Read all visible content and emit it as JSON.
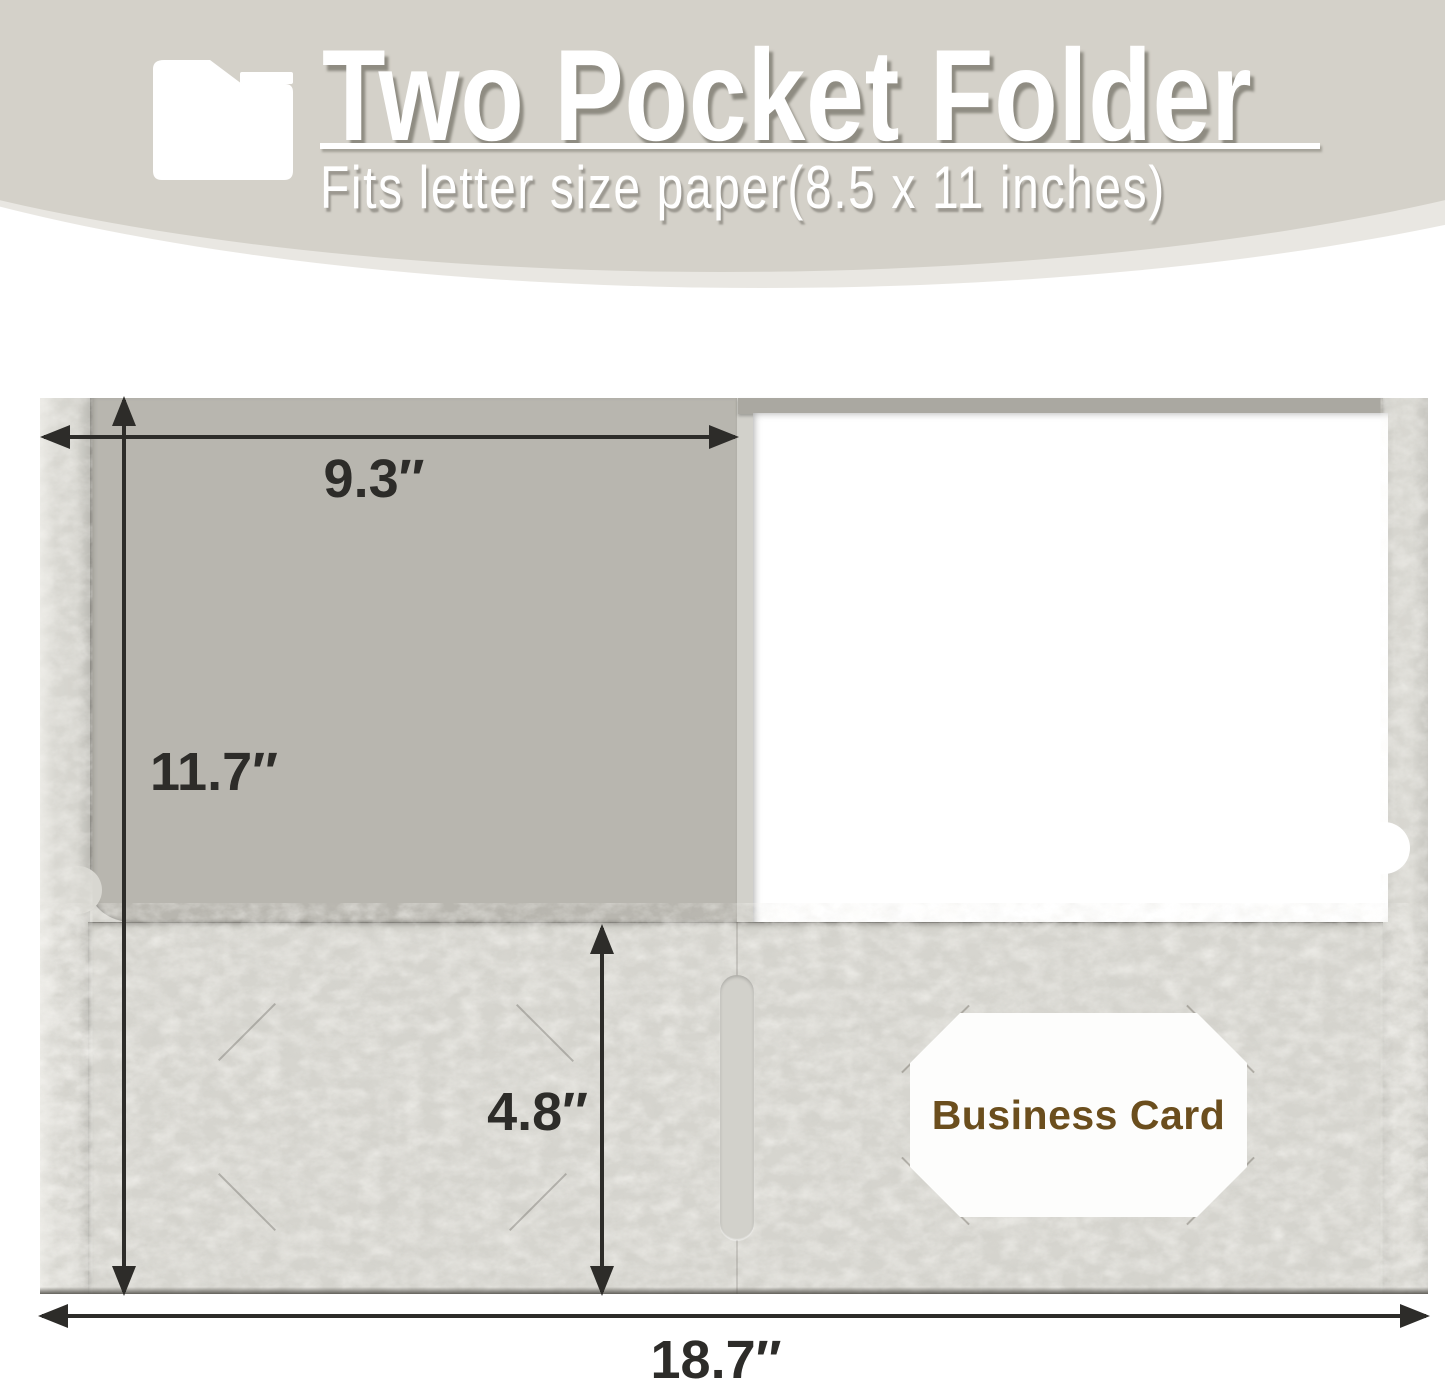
{
  "header": {
    "title": "Two Pocket Folder",
    "subtitle": "Fits letter size paper(8.5 x 11 inches)",
    "icon": "folder-icon",
    "background_color": "#d4d1c9",
    "text_color": "#ffffff"
  },
  "diagram": {
    "dimension_labels": {
      "pocket_panel_width": "9.3″",
      "folder_height": "11.7″",
      "pocket_height": "4.8″",
      "total_open_width": "18.7″"
    },
    "business_card_slot_label": "Business Card",
    "colors": {
      "inner_panel": "#b8b6af",
      "pocket_cover": "#d6d5cf",
      "spine_edge": "#d8d7d1",
      "paper": "#ffffff",
      "dimension_ink": "#2d2c29",
      "business_card_text": "#6b4e1d"
    }
  }
}
